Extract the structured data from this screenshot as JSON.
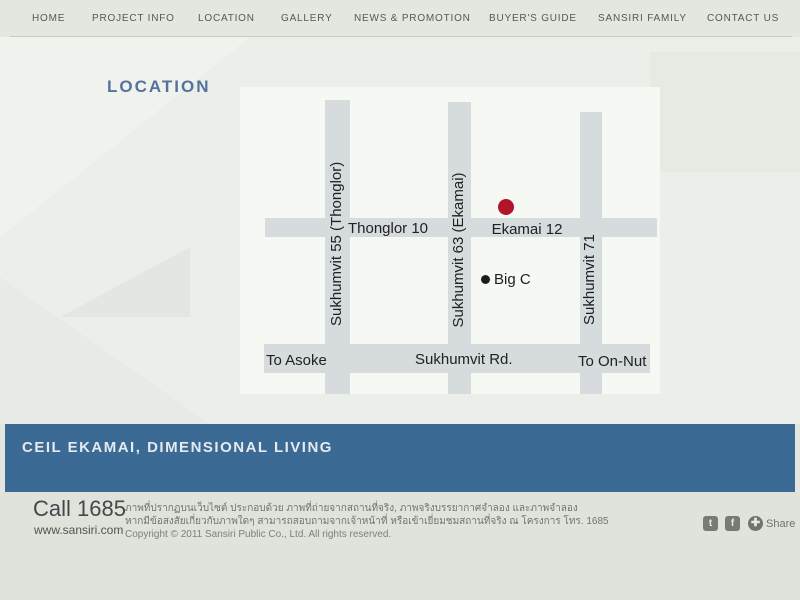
{
  "nav": {
    "items": [
      {
        "label": "HOME"
      },
      {
        "label": "PROJECT INFO"
      },
      {
        "label": "LOCATION"
      },
      {
        "label": "GALLERY"
      },
      {
        "label": "NEWS & PROMOTION"
      },
      {
        "label": "BUYER'S GUIDE"
      },
      {
        "label": "SANSIRI FAMILY"
      },
      {
        "label": "CONTACT US"
      }
    ]
  },
  "page": {
    "title": "LOCATION"
  },
  "map": {
    "vertical_roads": [
      {
        "label": "Sukhumvit 55 (Thonglor)"
      },
      {
        "label": "Sukhumvit 63 (Ekamai)"
      },
      {
        "label": "Sukhumvit 71"
      }
    ],
    "cross_road_labels": [
      {
        "label": "Thonglor 10"
      },
      {
        "label": "Ekamai 12"
      }
    ],
    "main_road": {
      "left_direction": "To Asoke",
      "label": "Sukhumvit Rd.",
      "right_direction": "To On-Nut"
    },
    "markers": [
      {
        "name": "project-location",
        "color": "#b2152a"
      },
      {
        "name": "big-c",
        "label": "Big C",
        "color": "#1b1c1e"
      }
    ]
  },
  "banner": {
    "title": "CEIL EKAMAI, DIMENSIONAL LIVING",
    "color": "#3b6a94"
  },
  "footer": {
    "call": "Call 1685",
    "website": "www.sansiri.com",
    "thai_line1": "ภาพที่ปรากฏบนเว็บไซต์ ประกอบด้วย ภาพที่ถ่ายจากสถานที่จริง, ภาพจริงบรรยากาศจำลอง และภาพจำลอง",
    "thai_line2": "หากมีข้อสงสัยเกี่ยวกับภาพใดๆ สามารถสอบถามจากเจ้าหน้าที่ หรือเข้าเยี่ยมชมสถานที่จริง ณ โครงการ โทร. 1685",
    "copyright": "Copyright © 2011 Sansiri Public Co., Ltd. All rights reserved.",
    "social": {
      "twitter_glyph": "t",
      "facebook_glyph": "f",
      "share_glyph": "✚",
      "share_label": "Share"
    }
  },
  "colors": {
    "banner_blue": "#3b6a94",
    "marker_red": "#b2152a",
    "road_gray": "#d6dbde",
    "heading_blue": "#54739b"
  }
}
